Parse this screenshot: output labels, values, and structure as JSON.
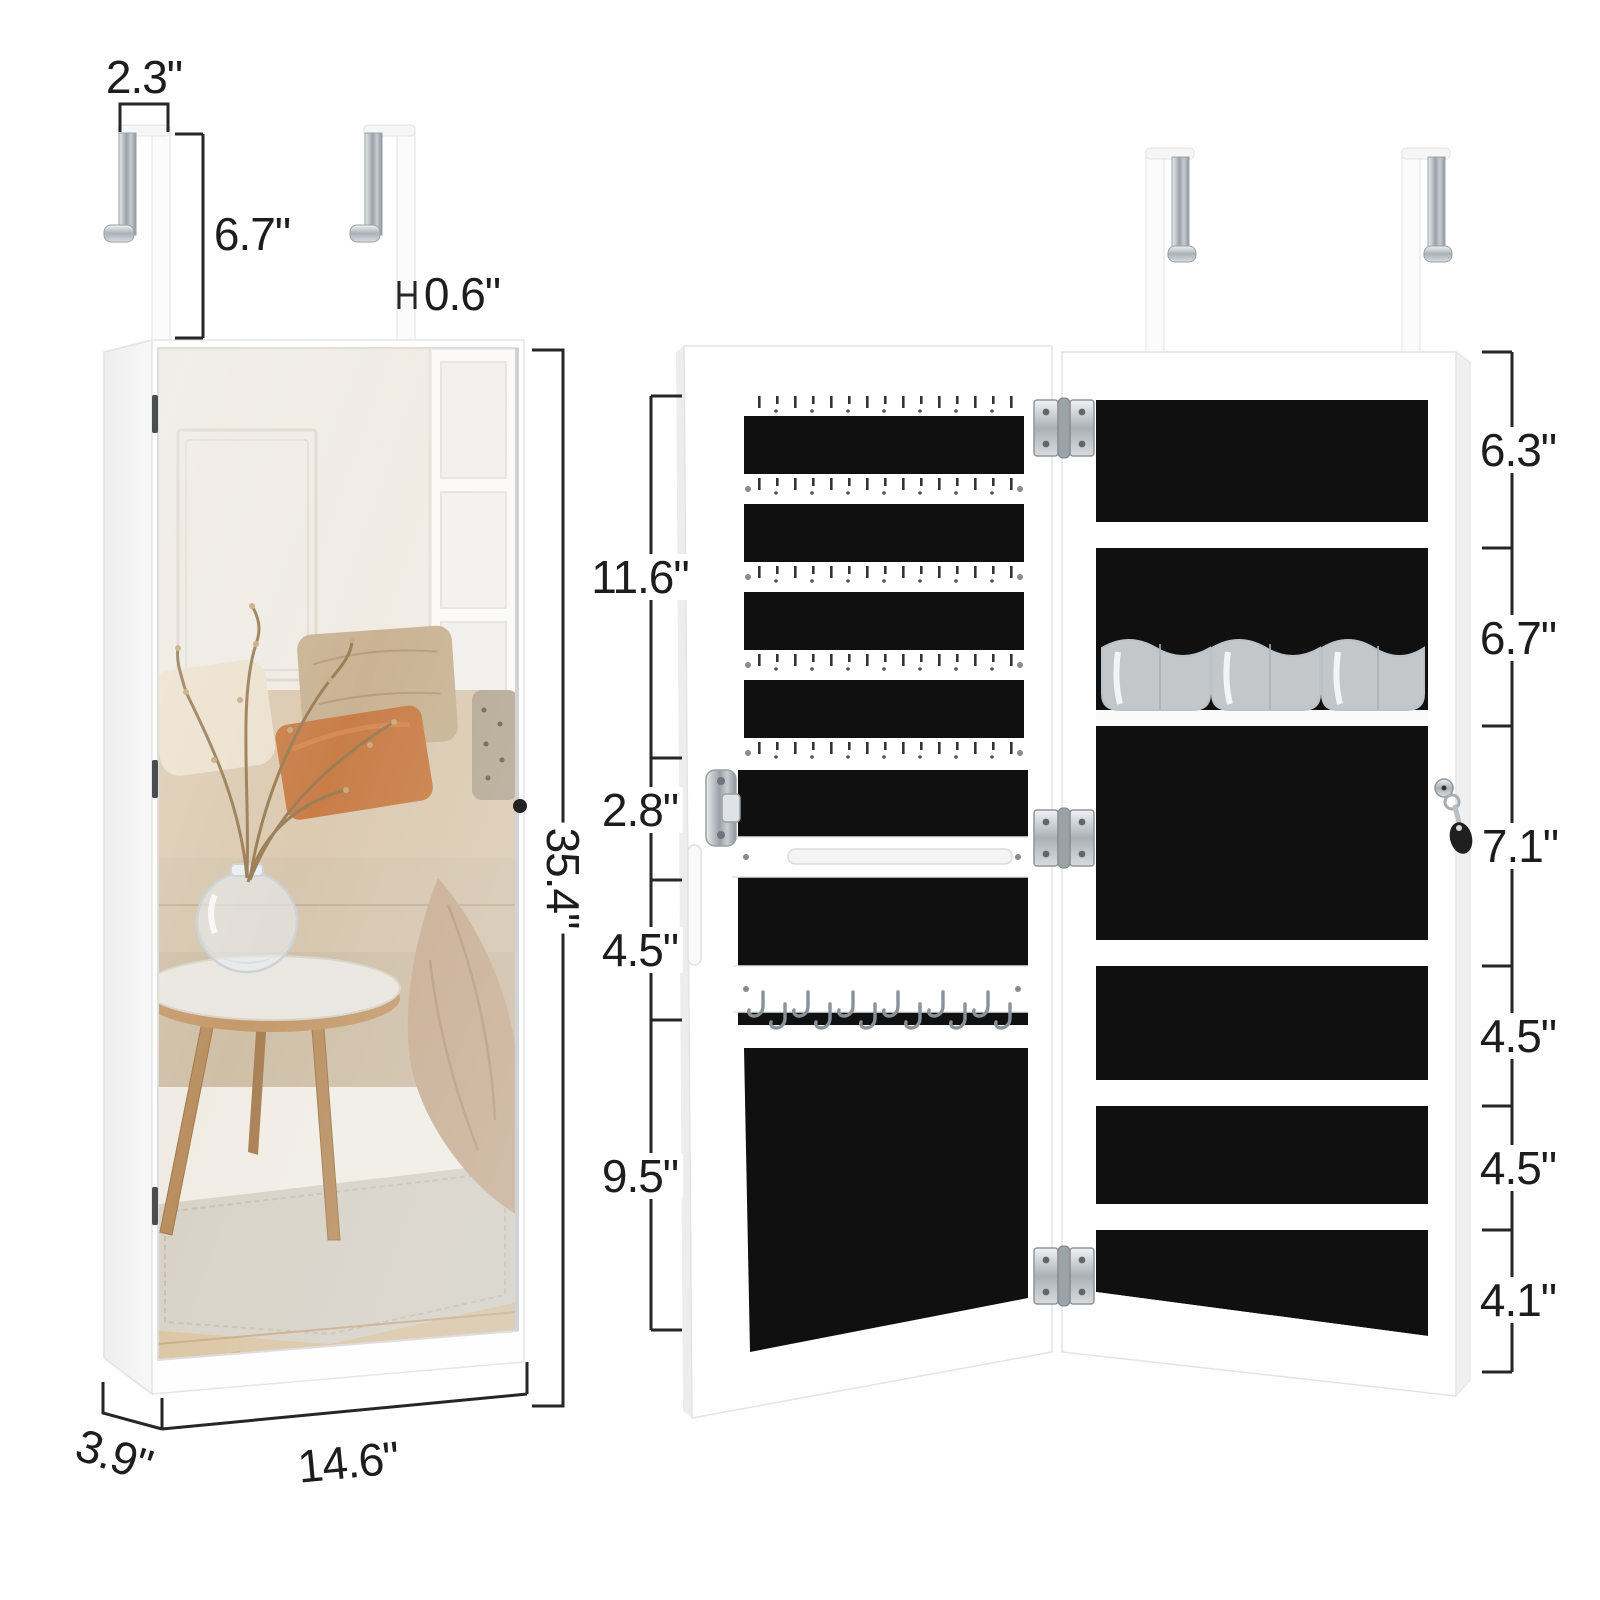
{
  "figure_title": "over-door mirror jewelry cabinet dimension diagram",
  "colors": {
    "background": "#ffffff",
    "dimension_line": "#262626",
    "label_text": "#1d1d1d",
    "felt_black": "#101010",
    "cabinet_white": "#ffffff",
    "chrome": "#9aa0a6"
  },
  "closed_unit": {
    "dimensions": {
      "hook_width": "2.3\"",
      "hook_drop": "6.7\"",
      "hook_bar_thickness": "0.6\"",
      "height": "35.4\"",
      "width": "14.6\"",
      "depth": "3.9\""
    }
  },
  "open_unit": {
    "door_sections": [
      "11.6\"",
      "2.8\"",
      "4.5\"",
      "9.5\""
    ],
    "body_sections": [
      "6.3\"",
      "6.7\"",
      "7.1\"",
      "4.5\"",
      "4.5\"",
      "4.1\""
    ]
  }
}
